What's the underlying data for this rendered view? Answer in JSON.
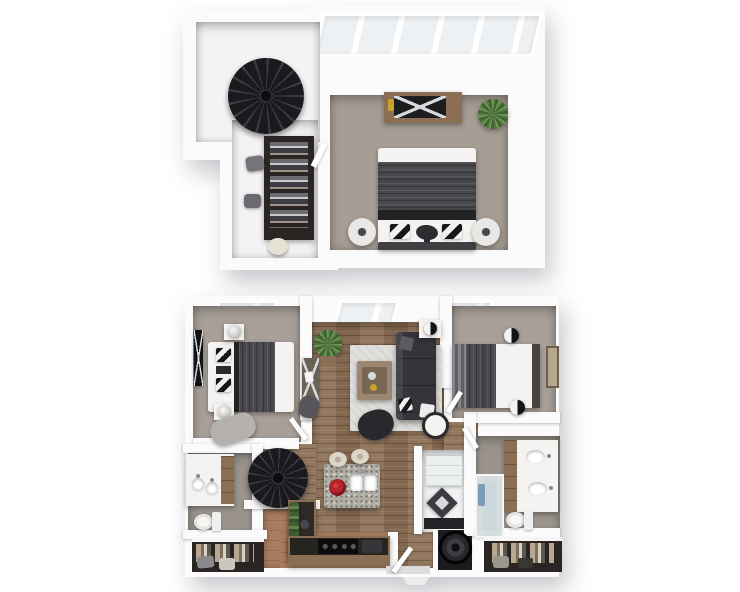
{
  "palette": {
    "canvas_bg": "#ffffff",
    "wall": "#fbfbfc",
    "carpet_upper": "#a69d94",
    "carpet_lower": "#a8a098",
    "landing_floor": "#f3f3f4",
    "wood_floor": "#8d7056",
    "kitchen_floor": "#a87c5d",
    "bath_floor": "#9a948c",
    "rug": "#e0dfdc",
    "charcoal": "#34343a",
    "duvet": "#47474c",
    "bed_white": "#f4f3f1",
    "wood_furniture": "#8a6f55",
    "stair_black": "#1a1a1e",
    "glass": "#eef1f3",
    "plant_green": "#55793f",
    "accent_red": "#b3242b",
    "closet_dark": "#2a2522",
    "granite": "#b0aea4"
  },
  "scene": {
    "type": "3d-floorplan-render",
    "levels": [
      {
        "id": "upper-loft-level",
        "rooms": [
          "loft-landing",
          "walk-in-closet",
          "loft-bedroom"
        ],
        "furniture": [
          "spiral-staircase",
          "wardrobe-with-clothes",
          "closet-ottomans",
          "round-stool",
          "dresser-with-tv",
          "potted-plant",
          "queen-bed",
          "drum-nightstands",
          "skylight-window-band"
        ]
      },
      {
        "id": "main-level",
        "rooms": [
          "bedroom-left",
          "living-room",
          "bedroom-right",
          "kitchen",
          "bathroom-left",
          "bathroom-right",
          "utility-laundry",
          "closet-left",
          "closet-right",
          "entry"
        ],
        "furniture": [
          "wall-tv",
          "bed-left",
          "nightstand-lamps",
          "chaise",
          "window-bands",
          "plant",
          "desk-with-chair",
          "area-rug",
          "coffee-table",
          "sectional-sofa",
          "accent-chair",
          "side-table-lamp",
          "floor-lamp",
          "bed-right",
          "wall-art",
          "kitchen-island-with-sink",
          "red-bowl",
          "bar-stools",
          "l-shaped-counter",
          "range-cooktop",
          "counter-herb-garden",
          "spiral-staircase",
          "double-vanity-left",
          "toilet-left",
          "double-vanity-right",
          "toilet-right",
          "shower",
          "washer",
          "wardrobe-closets",
          "entry-door"
        ]
      }
    ]
  }
}
